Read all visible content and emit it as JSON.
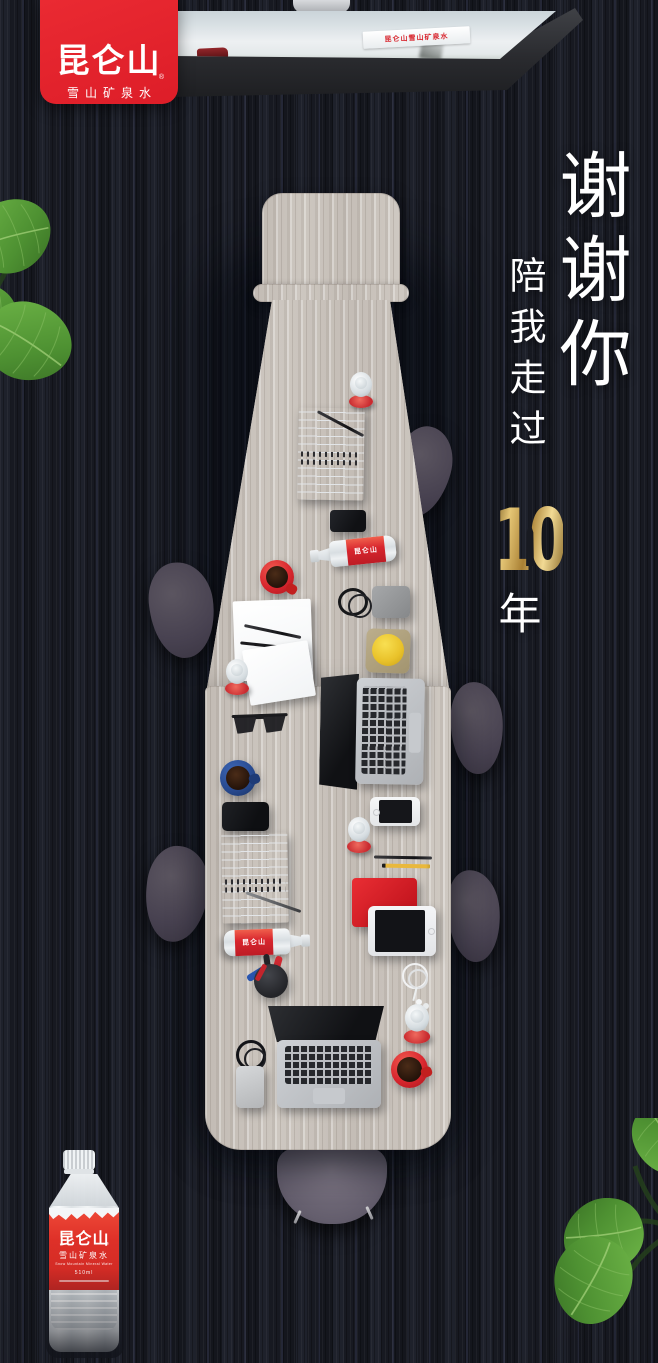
{
  "poster": {
    "logo_card": {
      "title": "昆仑山",
      "registered_mark": "®",
      "subtitle": "雪山矿泉水"
    },
    "tv": {
      "screen_banner": "昆仑山雪山矿泉水"
    },
    "headline": {
      "main_vertical": "谢谢你",
      "sub_vertical": "陪我走过",
      "anniversary_number": "10",
      "anniversary_unit": "年"
    },
    "table_items": {
      "bottle_label": "昆仑山"
    },
    "product_bottle": {
      "brand": "昆仑山",
      "registered_mark": "®",
      "subtitle": "雪山矿泉水",
      "subtitle_en": "Snow Mountain Mineral Water",
      "volume": "510ml"
    },
    "colors": {
      "brand_red": "#e2262e",
      "gold": "#c9a251",
      "carpet_dark": "#171921",
      "table_wood": "#c8c2bb",
      "leaf_green": "#5fa53e",
      "chair_gray": "#4c4650"
    }
  }
}
